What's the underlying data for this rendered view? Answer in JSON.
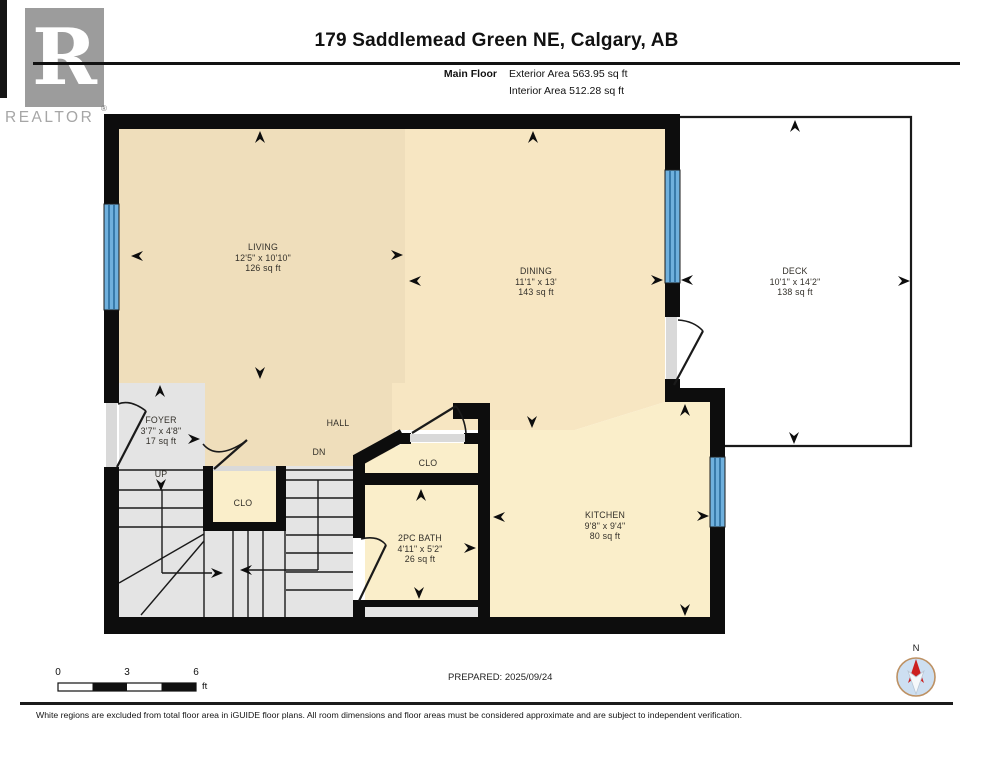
{
  "header": {
    "title": "179 Saddlemead Green NE, Calgary, AB",
    "floor_label": "Main Floor",
    "exterior_area": "Exterior Area 563.95 sq ft",
    "interior_area": "Interior Area 512.28 sq ft"
  },
  "logo": {
    "letter": "R",
    "brand": "REALTOR",
    "reg_mark": "®"
  },
  "rooms": {
    "living": {
      "name": "LIVING",
      "dims": "12'5\" x 10'10\"",
      "area": "126 sq ft"
    },
    "dining": {
      "name": "DINING",
      "dims": "11'1\" x 13'",
      "area": "143 sq ft"
    },
    "deck": {
      "name": "DECK",
      "dims": "10'1\" x 14'2\"",
      "area": "138 sq ft"
    },
    "kitchen": {
      "name": "KITCHEN",
      "dims": "9'8\" x 9'4\"",
      "area": "80 sq ft"
    },
    "bath": {
      "name": "2PC BATH",
      "dims": "4'11\" x 5'2\"",
      "area": "26 sq ft"
    },
    "foyer": {
      "name": "FOYER",
      "dims": "3'7\" x 4'8\"",
      "area": "17 sq ft"
    },
    "hall": {
      "name": "HALL"
    },
    "closet1": {
      "name": "CLO"
    },
    "closet2": {
      "name": "CLO"
    },
    "stairs_up_label": "UP",
    "stairs_down_label": "DN"
  },
  "scale_bar": {
    "ticks": [
      "0",
      "3",
      "6"
    ],
    "unit": "ft"
  },
  "prepared": "PREPARED: 2025/09/24",
  "compass": {
    "north_label": "N"
  },
  "footer": {
    "disclaimer": "White regions are excluded from total floor area in iGUIDE floor plans. All room dimensions and floor areas must be considered approximate and are subject to independent verification."
  },
  "colors": {
    "wall": "#0d0d0d",
    "living_hall_floor": "#efdebb",
    "dining_floor": "#f7e6c2",
    "kitchen_bath_floor": "#faeeca",
    "stairs_foyer_floor": "#e4e4e4",
    "window_fill": "#6fb0dd",
    "window_line": "#2a6d9e",
    "door_sill": "#d9d9d9",
    "compass_north": "#cc2020",
    "compass_face": "#cddff1",
    "logo_gray": "#9c9c9c"
  }
}
